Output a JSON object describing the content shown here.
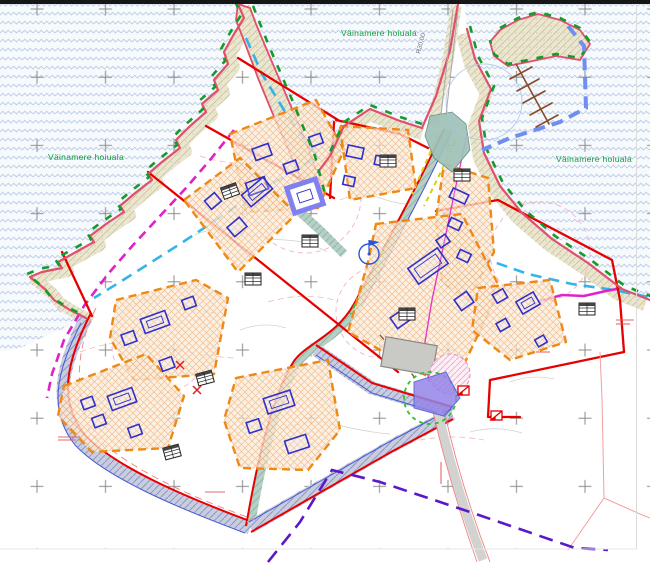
{
  "labels": {
    "protected_area": "Väinamere hoiuala",
    "radius_annotation": "R30.00"
  },
  "colors": {
    "water_wave": "#bccde6",
    "shoreline": "#e0506e",
    "shore_vegetation": "#149c28",
    "beach": "#ebe6d0",
    "plot_boundary": "#e80000",
    "building_envelope": "#f08814",
    "envelope_fill": "#faecd9",
    "planned_building": "#3030c8",
    "special_building": "#8080f0",
    "existing_building": "#c9c9c5",
    "road_hatch": "#c9cde0",
    "road_teal": "#b5d0c5",
    "harbor_boundary": "#6f8ef0",
    "pier": "#8a4c28",
    "utility_magenta": "#e020c8",
    "buffer_cyan": "#2ab0e8",
    "cable_purple": "#5a18c8",
    "cadastral_pink": "#f2a0a0",
    "label_green": "#12a040",
    "grid_cross": "#8c8c8c"
  },
  "legend_semantics": {
    "water": "sea with wave pattern",
    "green_label": "protected area name",
    "red_lines": "planned plot boundaries",
    "orange_dashed": "building envelopes",
    "blue_rectangles": "planned buildings",
    "gray_building": "existing building",
    "blue_dashed_polyline": "harbor water area boundary",
    "brown_lines": "pier",
    "tables": "plot data tables",
    "crosses": "coordinate grid"
  }
}
